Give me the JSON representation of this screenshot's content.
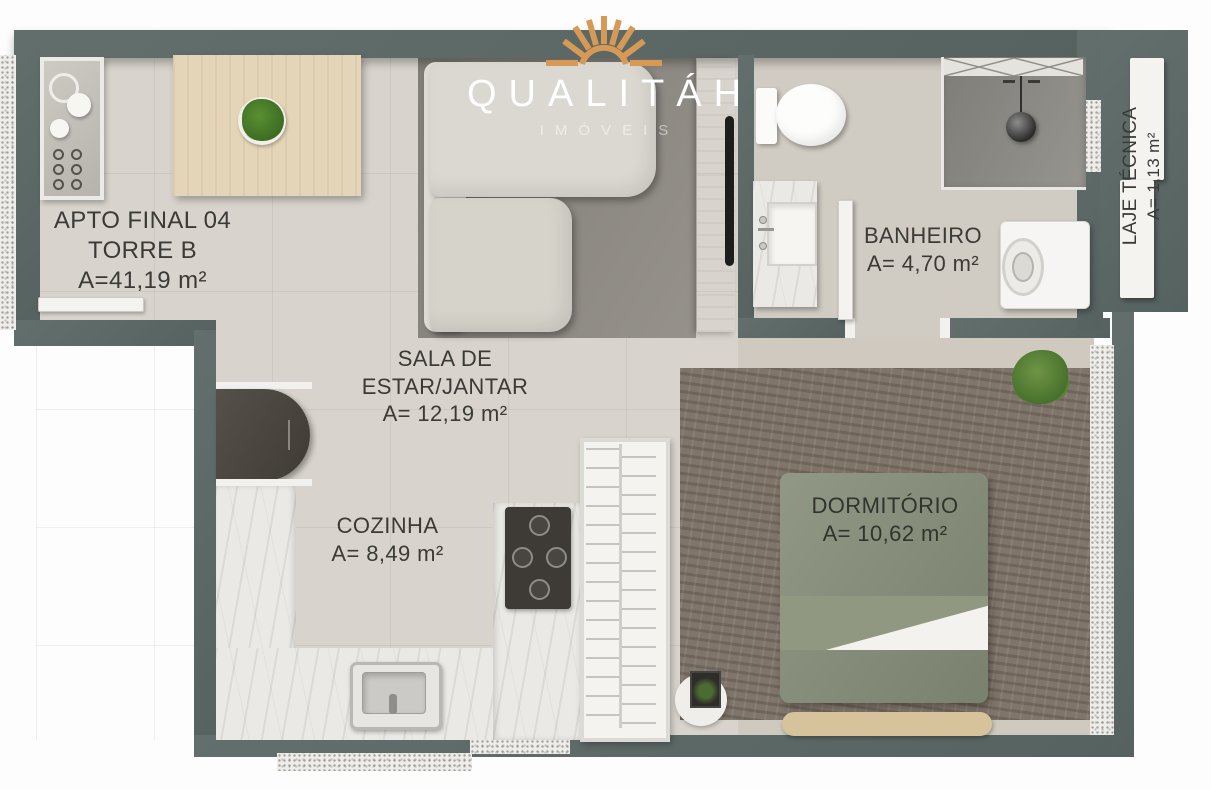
{
  "brand": {
    "name": "QUALITÁH",
    "tagline": "IMÓVEIS",
    "accent_color": "#d79a56"
  },
  "rooms": {
    "apto": {
      "line1": "APTO FINAL 04",
      "line2": "TORRE B",
      "line3": "A=41,19 m²"
    },
    "sala": {
      "line1": "SALA DE",
      "line2": "ESTAR/JANTAR",
      "line3": "A= 12,19 m²"
    },
    "cozinha": {
      "line1": "COZINHA",
      "line2": "A= 8,49 m²"
    },
    "banheiro": {
      "line1": "BANHEIRO",
      "line2": "A= 4,70 m²"
    },
    "dormitorio": {
      "line1": "DORMITÓRIO",
      "line2": "A= 10,62 m²"
    },
    "laje": {
      "line1": "LAJE TÉCNICA",
      "line2": "A= 1,13 m²"
    }
  },
  "colors": {
    "wall": "#5c6866",
    "floor_living": "#d8d4cd",
    "floor_bath": "#d1ccc3",
    "floor_bedroom": "#cfc9bf",
    "rug_living": "#8f8b84",
    "rug_bedroom": "#80756a",
    "bed_green": "#87907b",
    "wood_light": "#e4d5b8",
    "marble": "#ebe9e6",
    "label_text": "#3a3a36",
    "logo_accent": "#d79a56"
  }
}
